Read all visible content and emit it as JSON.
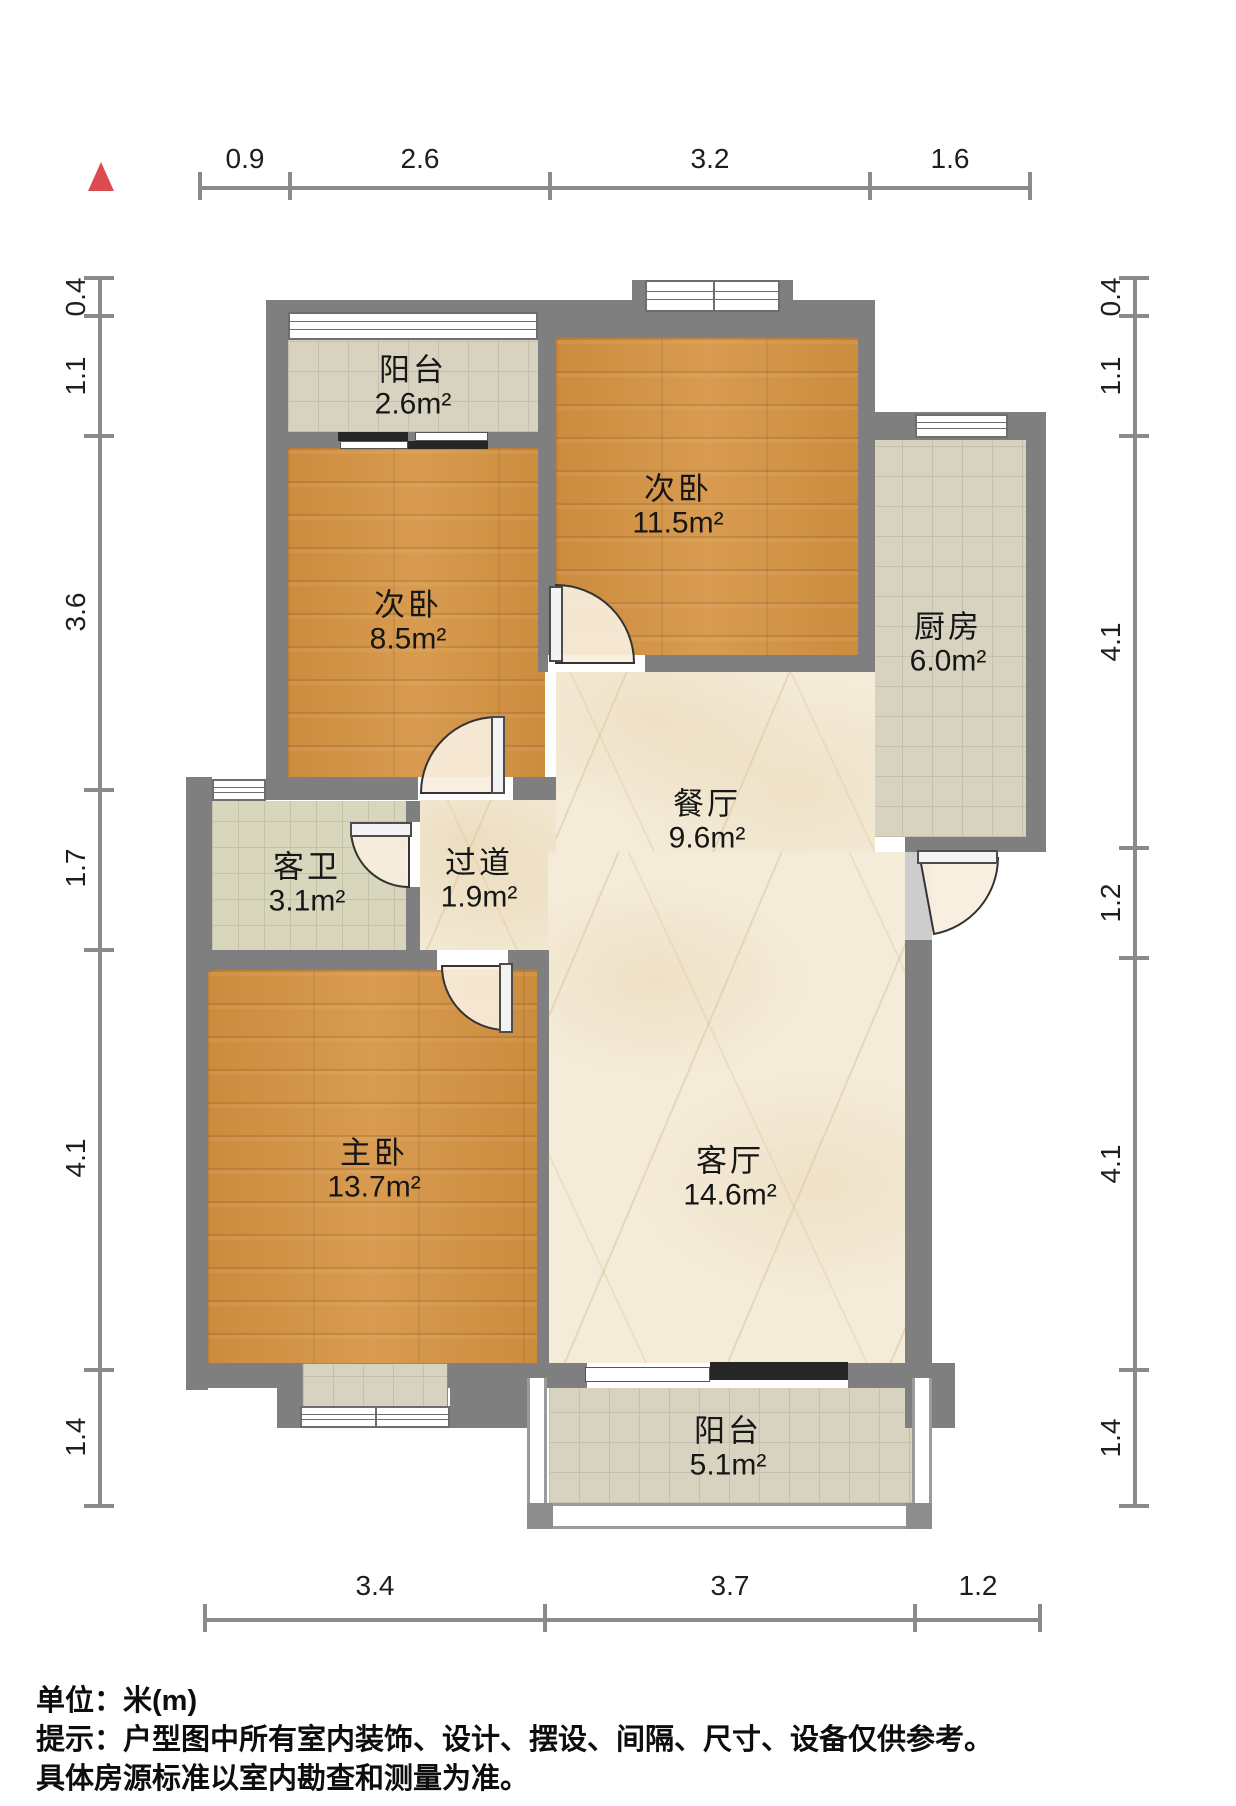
{
  "compass": {
    "description": "north-indicator-triangle",
    "color": "#dd4a50"
  },
  "dims": {
    "top": [
      "0.9",
      "2.6",
      "3.2",
      "1.6"
    ],
    "bottom": [
      "3.4",
      "3.7",
      "1.2"
    ],
    "left": [
      "0.4",
      "1.1",
      "3.6",
      "1.7",
      "4.1",
      "1.4"
    ],
    "right": [
      "0.4",
      "1.1",
      "4.1",
      "1.2",
      "4.1",
      "1.4"
    ]
  },
  "rooms": [
    {
      "id": "balcony-top",
      "name": "阳台",
      "area": "2.6m²"
    },
    {
      "id": "bedroom-small",
      "name": "次卧",
      "area": "8.5m²"
    },
    {
      "id": "bedroom-large",
      "name": "次卧",
      "area": "11.5m²"
    },
    {
      "id": "kitchen",
      "name": "厨房",
      "area": "6.0m²"
    },
    {
      "id": "bathroom",
      "name": "客卫",
      "area": "3.1m²"
    },
    {
      "id": "hallway",
      "name": "过道",
      "area": "1.9m²"
    },
    {
      "id": "dining",
      "name": "餐厅",
      "area": "9.6m²"
    },
    {
      "id": "master-bedroom",
      "name": "主卧",
      "area": "13.7m²"
    },
    {
      "id": "living",
      "name": "客厅",
      "area": "14.6m²"
    },
    {
      "id": "balcony-bottom",
      "name": "阳台",
      "area": "5.1m²"
    }
  ],
  "footer": {
    "unit_label": "单位：米(m)",
    "note_line1": "提示：户型图中所有室内装饰、设计、摆设、间隔、尺寸、设备仅供参考。",
    "note_line2": "具体房源标准以室内勘查和测量为准。"
  }
}
